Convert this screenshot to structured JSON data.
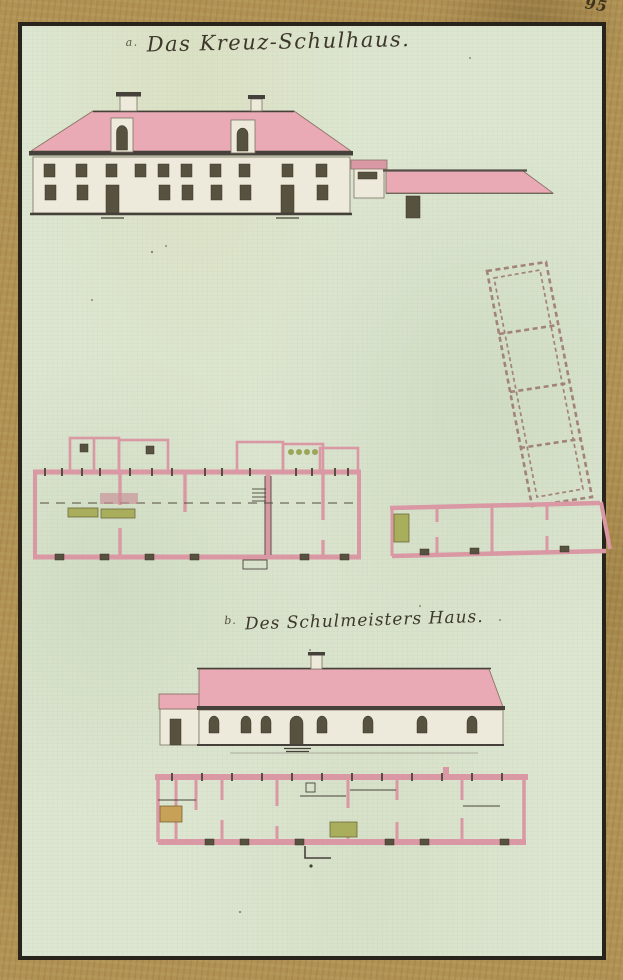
{
  "page": {
    "folio_number": "95",
    "figures": {
      "a": {
        "marker": "a.",
        "title": "Das Kreuz-Schulhaus."
      },
      "b": {
        "marker": "b.",
        "title": "Des Schulmeisters Haus."
      }
    }
  },
  "colors": {
    "border_gold": "#b19254",
    "frame_ink": "#28231b",
    "paper_green": "#dde6d1",
    "roof_pink": "#e9aab6",
    "wall_pink": "#d998a3",
    "ink_dark": "#46403a",
    "stove_green": "#a9ae5c",
    "stove_ochre": "#c8a158",
    "title_ink": "#3e382c"
  }
}
